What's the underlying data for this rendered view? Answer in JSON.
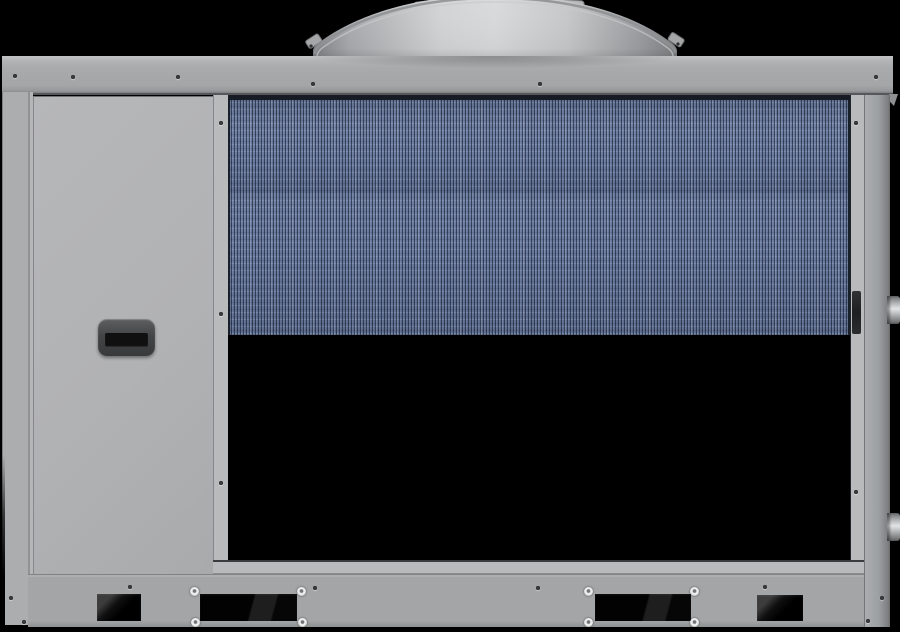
{
  "scene": {
    "subject": "grey industrial air-cooled chiller cabinet, front view, black background",
    "no_visible_text": true
  },
  "structure": {
    "fan_shrouds": 1,
    "coil_sections": 3,
    "coil_separators": 2,
    "bottom_vents": 4,
    "side_pipes": 2,
    "corner_bolts": 8,
    "door_handles": 1
  },
  "colors": {
    "bg": "#000000",
    "rail": "#a8aaac",
    "rail-dark": "#7d7f81",
    "left-col": "#abadaf",
    "door": "#b1b2b4",
    "door-edge": "#85878a",
    "frame": "#b9babc",
    "right-face": "#9da0a2",
    "base": "#a3a5a7",
    "coil-base": "#64759b",
    "coil-frame": "#171c24",
    "handle": "#434547",
    "handle-slot": "#101011",
    "fan-light": "#d8d9da",
    "fan-edge": "#838588",
    "bolt": "#eceded",
    "screw": "#3a3c3e",
    "vent": "#050505"
  },
  "hardware": {
    "screws": [
      [
        15,
        76
      ],
      [
        73,
        77
      ],
      [
        178,
        77
      ],
      [
        313,
        84
      ],
      [
        540,
        84
      ],
      [
        876,
        77
      ],
      [
        221,
        123
      ],
      [
        221,
        314
      ],
      [
        221,
        483
      ],
      [
        856,
        123
      ],
      [
        856,
        492
      ],
      [
        130,
        587
      ],
      [
        315,
        588
      ],
      [
        538,
        588
      ],
      [
        765,
        587
      ],
      [
        11,
        598
      ],
      [
        24,
        622
      ],
      [
        882,
        598
      ],
      [
        868,
        621
      ]
    ],
    "bolts": [
      [
        194,
        591
      ],
      [
        301,
        591
      ],
      [
        195,
        622
      ],
      [
        302,
        622
      ],
      [
        588,
        591
      ],
      [
        694,
        591
      ],
      [
        588,
        622
      ],
      [
        694,
        622
      ]
    ],
    "vents": [
      {
        "x": 97,
        "y": 594,
        "w": 44,
        "h": 27,
        "kind": "small"
      },
      {
        "x": 200,
        "y": 594,
        "w": 97,
        "h": 27,
        "kind": "big"
      },
      {
        "x": 595,
        "y": 594,
        "w": 96,
        "h": 27,
        "kind": "big"
      },
      {
        "x": 757,
        "y": 595,
        "w": 46,
        "h": 26,
        "kind": "small"
      }
    ],
    "pipes": [
      {
        "x": 887,
        "y": 296,
        "w": 13,
        "h": 28
      },
      {
        "x": 887,
        "y": 513,
        "w": 13,
        "h": 28
      }
    ]
  }
}
